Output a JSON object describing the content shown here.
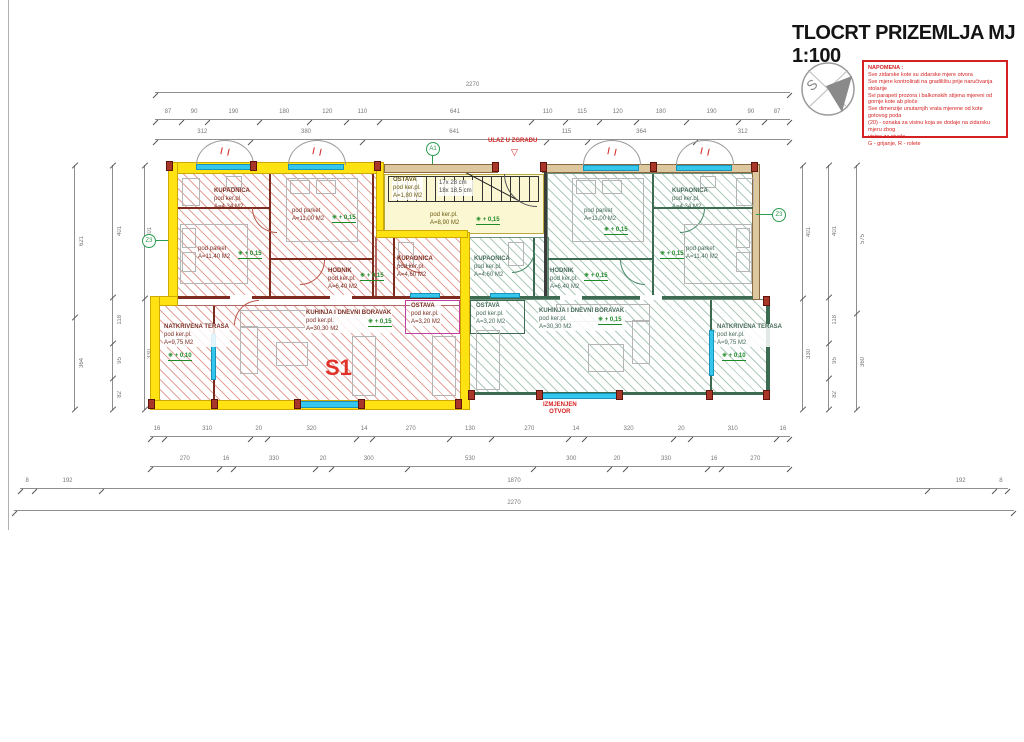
{
  "title": "TLOCRT PRIZEMLJA MJ 1:100",
  "compass": {
    "letter": "S"
  },
  "napomena": {
    "heading": "NAPOMENA :",
    "lines": [
      "Sve zidarske kote su zidarske mjere otvora",
      "Sve mjere kontrolirati na gradilištu prije naručivanja stolarije",
      "Svi parapeti prozora i balkonskih stijena mjereni od gornje kote ab ploče",
      "Sve dimenzije unutarnjih vrata mjerene od kote gotovog poda",
      "(20) - oznaka za visinu koja se dodaje na zidarsku mjeru zbog",
      "visine za nivele",
      "G - grijanje, R - rolete"
    ]
  },
  "entrance": {
    "label": "ULAZ U ZGRADU",
    "arrow": "▽"
  },
  "unit_label": "S1",
  "changed_opening": {
    "line1": "IZMJENJEN",
    "line2": "OTVOR"
  },
  "axis_tags": {
    "top": "A1",
    "left": "Z3",
    "right": "Z3"
  },
  "stairs": {
    "note1": "17x 28 cm",
    "note2": "18x 18,5 cm"
  },
  "elevations": {
    "interior": "+ 0,15",
    "terrace": "+ 0,10"
  },
  "rooms": {
    "left": {
      "bath_top": {
        "name": "KUPAONICA",
        "floor": "pod ker.pl.",
        "area": "A=4,34 M2"
      },
      "bed_small": {
        "floor": "pod parket",
        "area": "A=11,40 M2"
      },
      "bed_large": {
        "floor": "pod parket",
        "area": "A=11,00 M2"
      },
      "hall": {
        "name": "HODNIK",
        "floor": "pod ker.pl.",
        "area": "A=6,40 M2"
      },
      "bath_inner": {
        "name": "KUPAONICA",
        "floor": "pod ker.pl.",
        "area": "A=4,60 M2"
      },
      "storage": {
        "name": "OSTAVA",
        "floor": "pod ker.pl.",
        "area": "A=3,20 M2"
      },
      "living": {
        "name": "KUHINJA I DNEVNI BORAVAK",
        "floor": "pod ker.pl.",
        "area": "A=30,30 M2"
      },
      "terrace": {
        "name": "NATKRIVENA TERASA",
        "floor": "pod ker.pl.",
        "area": "A=9,75 M2"
      }
    },
    "right": {
      "bath_top": {
        "name": "KUPAONICA",
        "floor": "pod ker.pl.",
        "area": "A=4,34 M2"
      },
      "bed_small": {
        "floor": "pod parket",
        "area": "A=11,40 M2"
      },
      "bed_large": {
        "floor": "pod parket",
        "area": "A=11,00 M2"
      },
      "hall": {
        "name": "HODNIK",
        "floor": "pod ker.pl.",
        "area": "A=6,40 M2"
      },
      "bath_inner": {
        "name": "KUPAONICA",
        "floor": "pod ker.pl.",
        "area": "A=4,60 M2"
      },
      "storage": {
        "name": "OSTAVA",
        "floor": "pod ker.pl.",
        "area": "A=3,20 M2"
      },
      "living": {
        "name": "KUHINJA I DNEVNI BORAVAK",
        "floor": "pod ker.pl.",
        "area": "A=30,30 M2"
      },
      "terrace": {
        "name": "NATKRIVENA TERASA",
        "floor": "pod ker.pl.",
        "area": "A=9,75 M2"
      }
    },
    "stairwell": {
      "storage": {
        "name": "OSTAVA",
        "floor": "pod ker.pl.",
        "area": "A=1,80 M2"
      },
      "corridor": {
        "floor": "pod ker.pl.",
        "area": "A=8,90 M2"
      }
    }
  },
  "dims": {
    "top_overall": "2270",
    "top_row2": [
      "87",
      "90",
      "190",
      "180",
      "120",
      "110",
      "641",
      "110",
      "115",
      "120",
      "180",
      "190",
      "90",
      "87"
    ],
    "top_row3": [
      "312",
      "380",
      "641",
      "115",
      "364",
      "312"
    ],
    "bottom_row1": [
      "16",
      "310",
      "20",
      "320",
      "14",
      "270",
      "130",
      "270",
      "14",
      "320",
      "20",
      "310",
      "16"
    ],
    "bottom_row2": [
      "270",
      "16",
      "330",
      "20",
      "300",
      "530",
      "300",
      "20",
      "330",
      "16",
      "270"
    ],
    "bottom_row3": [
      "8",
      "192",
      "1870",
      "192",
      "8"
    ],
    "bottom_overall": "2270",
    "left_col1": [
      "621",
      "364"
    ],
    "left_col2": [
      "401",
      "118",
      "95",
      "82"
    ],
    "left_col3": [
      "401",
      "330"
    ],
    "right_col1": [
      "401",
      "330"
    ],
    "right_col2": [
      "401",
      "118",
      "95",
      "82"
    ],
    "right_col3": [
      "575",
      "360"
    ]
  },
  "colors": {
    "highlight": "#ffe212",
    "hatch_left": "#c85a48",
    "hatch_right": "#5f9678",
    "window": "#35c6ee",
    "note_red": "#d42222",
    "elevation_green": "#1f8a28"
  }
}
